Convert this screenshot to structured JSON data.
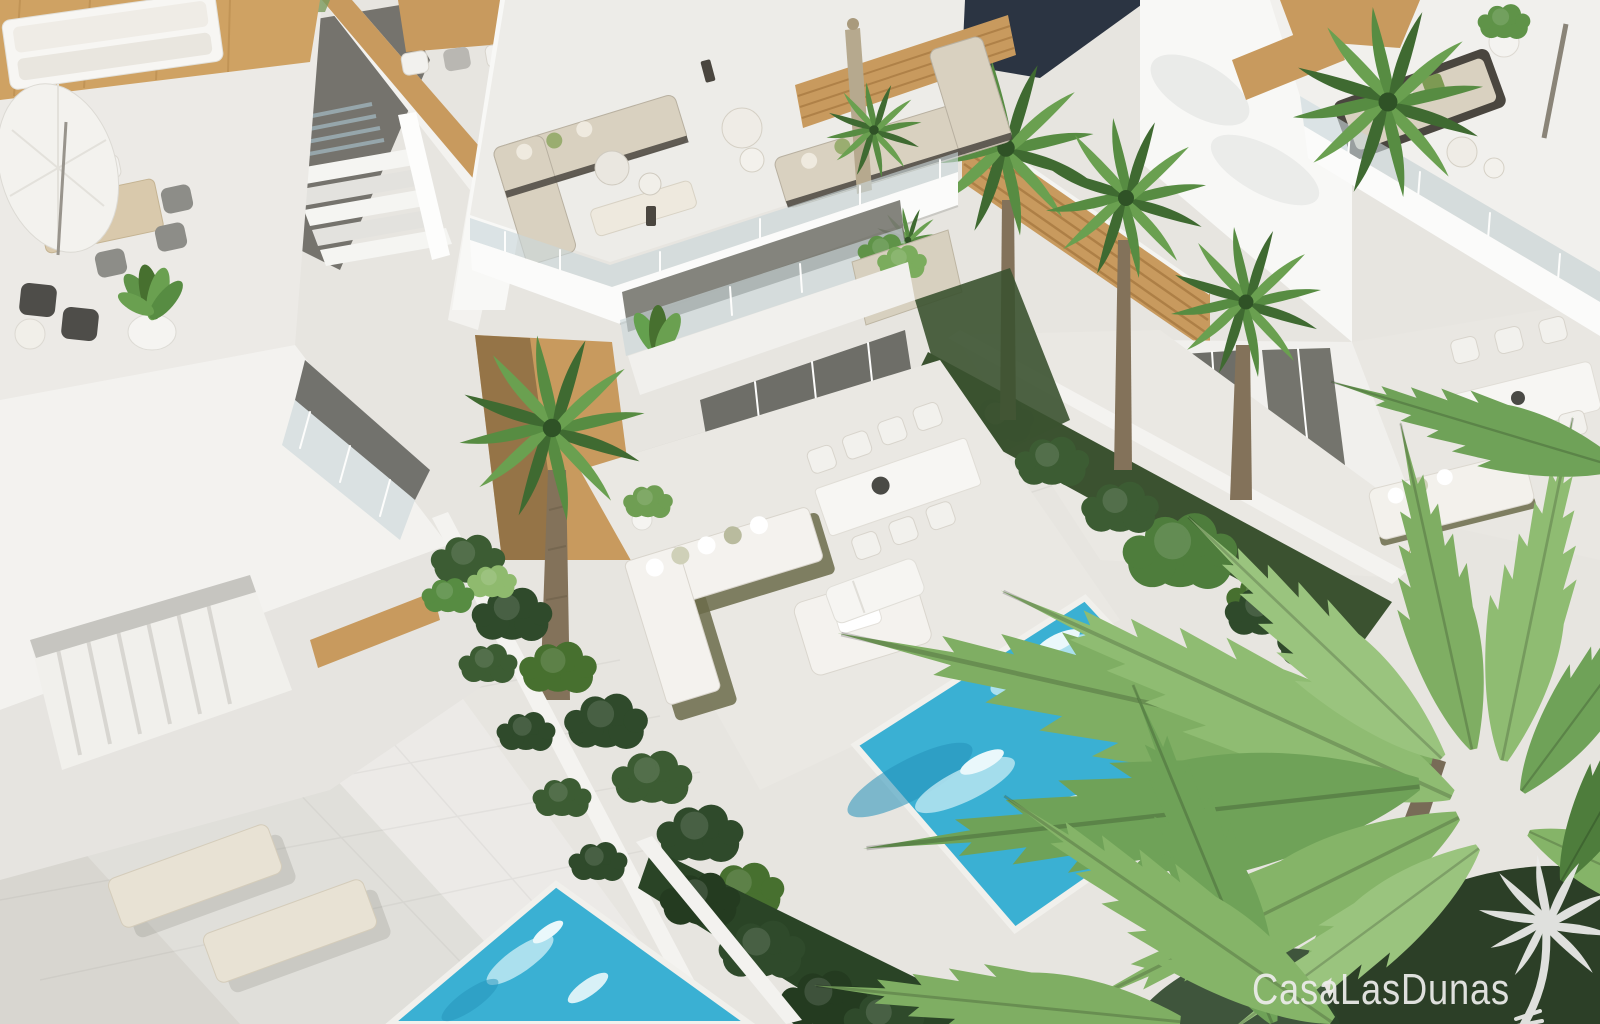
{
  "image": {
    "type": "architectural-3d-render",
    "view": "aerial",
    "subject": "Modern white holiday villas with rooftop terraces, private plunge pools and palm garden"
  },
  "watermark": {
    "brand": "CasaLasDunas",
    "logo": "palm-tree"
  },
  "palette": {
    "paving": "#e7e5e0",
    "wall_bright": "#f8f8f6",
    "wall": "#f1f0ed",
    "wall_shade": "#e4e3df",
    "wood": "#c89a5e",
    "glass": "#c9d6da",
    "dark_opening": "#6e6e68",
    "night_band": "#2b3442",
    "pool": "#3ab0d3",
    "pool_deep": "#2492ba",
    "pool_light": "#bfe9f2",
    "foliage_dark": "#2f4a2b",
    "foliage": "#578c42",
    "foliage_light": "#8fba6e",
    "palm_trunk": "#83725a",
    "cushion": "#d9d1c0",
    "furniture_frame": "#4a463f",
    "watermark": "#ededeb"
  },
  "scene": {
    "buildings": [
      "left villa with furnished roof terrace",
      "central villa with roof lounge, balcony and garden terrace",
      "right villa with timber-clad walls",
      "upper-right roof terrace with lounge set",
      "far-right terrace with dining set"
    ],
    "features": [
      "turquoise plunge pool",
      "second pool at lower-left patio",
      "tall fan palms",
      "clipped hedges along white garden walls",
      "sun loungers",
      "outdoor sofas and dining sets",
      "white parasol",
      "glass balustrades",
      "large foreground palm fronds"
    ]
  }
}
